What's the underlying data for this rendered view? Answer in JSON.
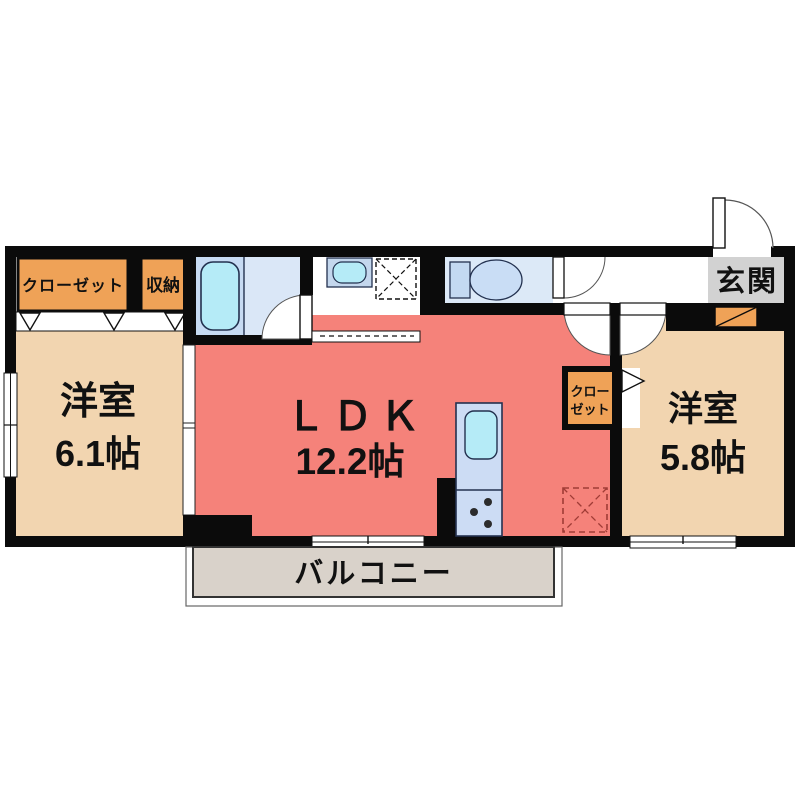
{
  "plan": {
    "type": "apartment-floor-plan-1LDK-2room",
    "rooms": {
      "bedroom_left": {
        "name": "洋室",
        "size": "6.1帖"
      },
      "ldk": {
        "name": "ＬＤＫ",
        "size": "12.2帖"
      },
      "bedroom_right": {
        "name": "洋室",
        "size": "5.8帖"
      },
      "balcony": {
        "name": "バルコニー"
      },
      "entrance": {
        "name": "玄関"
      },
      "closet_main": {
        "name": "クローゼット"
      },
      "storage": {
        "name": "収納"
      },
      "closet_small": {
        "line1": "クロー",
        "line2": "ゼット"
      }
    },
    "colors": {
      "wall": "#0b0b0b",
      "bedroom_floor": "#F2D5B0",
      "ldk_floor": "#F5827A",
      "closet_fill": "#EFA257",
      "bath_room": "#DAE7F7",
      "bath_tub_panel": "#C7DBF3",
      "tub_water": "#B5EBF7",
      "fixture_blue": "#C3D9F2",
      "kitchen_counter": "#CCDCF4",
      "entrance_floor": "#D2D2D2",
      "balcony_floor": "#D9D2CA",
      "fridge_dash": "#A03C36"
    }
  }
}
